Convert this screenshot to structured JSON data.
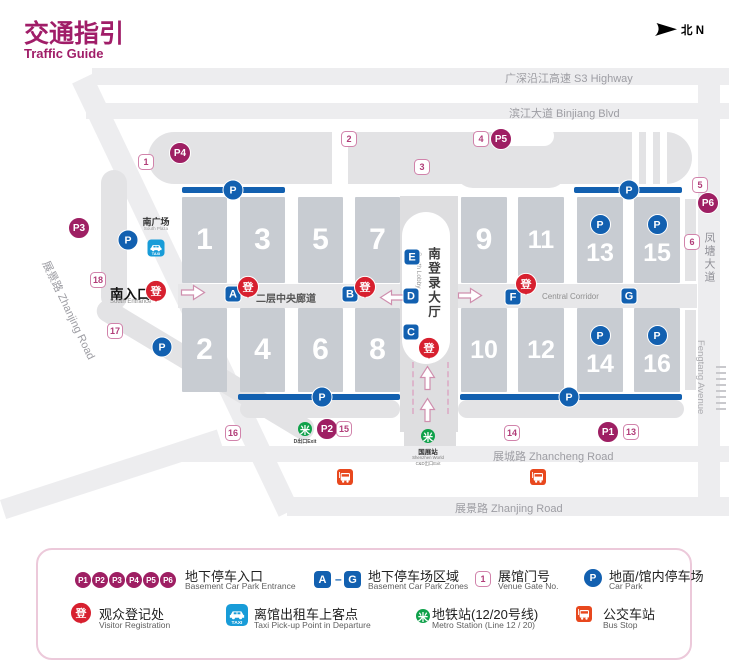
{
  "header": {
    "title_zh": "交通指引",
    "title_en": "Traffic Guide",
    "compass": "北 N"
  },
  "symbols": {
    "p": "P",
    "reg": "登",
    "taxi": "TAXI",
    "metro_glyph": "米",
    "dash": "–"
  },
  "colors": {
    "magenta": "#9e1f63",
    "blue": "#1260b0",
    "red": "#d7202f",
    "taxi_blue": "#189cd8",
    "green": "#0fa14a",
    "orange": "#e8481e",
    "hall_gray": "#c8ccd2"
  },
  "roads": {
    "s3": "广深沿江高速 S3 Highway",
    "binjiang": "滨江大道 Binjiang Blvd",
    "zhanjing_diag": "展景路 Zhanjing Road",
    "zhancheng": "展城路 Zhancheng Road",
    "zhanjing_bottom": "展景路 Zhanjing Road",
    "fengtang_zh": "凤塘大道",
    "fengtang_en": "Fengtang Avenue"
  },
  "labels": {
    "south_plaza_zh": "南广场",
    "south_plaza_en": "South Plaza",
    "south_entrance_zh": "南入口",
    "south_entrance_en": "South Entrance",
    "south_lobby_zh": "南登录大厅",
    "south_lobby_en": "South Lobby",
    "corridor_zh": "二层中央廊道",
    "corridor_en": "Central Corridor",
    "metro_d_exit": "D出口Exit",
    "station_zh": "国展站",
    "station_en": "Shenzhen World",
    "station_exit": "C&D出口Exit"
  },
  "map": {
    "halls": [
      {
        "num": "1",
        "x": 182,
        "y": 197,
        "w": 45,
        "h": 86
      },
      {
        "num": "3",
        "x": 240,
        "y": 197,
        "w": 45,
        "h": 86
      },
      {
        "num": "5",
        "x": 298,
        "y": 197,
        "w": 45,
        "h": 86
      },
      {
        "num": "7",
        "x": 355,
        "y": 197,
        "w": 45,
        "h": 86
      },
      {
        "num": "9",
        "x": 461,
        "y": 197,
        "w": 46,
        "h": 86
      },
      {
        "num": "11",
        "x": 518,
        "y": 197,
        "w": 46,
        "h": 86
      },
      {
        "num": "13",
        "x": 577,
        "y": 197,
        "w": 46,
        "h": 86,
        "p": true
      },
      {
        "num": "15",
        "x": 634,
        "y": 197,
        "w": 46,
        "h": 86,
        "p": true
      },
      {
        "num": "2",
        "x": 182,
        "y": 308,
        "w": 45,
        "h": 84
      },
      {
        "num": "4",
        "x": 240,
        "y": 308,
        "w": 45,
        "h": 84
      },
      {
        "num": "6",
        "x": 298,
        "y": 308,
        "w": 45,
        "h": 84
      },
      {
        "num": "8",
        "x": 355,
        "y": 308,
        "w": 45,
        "h": 84
      },
      {
        "num": "10",
        "x": 461,
        "y": 308,
        "w": 46,
        "h": 84
      },
      {
        "num": "12",
        "x": 518,
        "y": 308,
        "w": 46,
        "h": 84
      },
      {
        "num": "14",
        "x": 577,
        "y": 308,
        "w": 46,
        "h": 84,
        "p": true
      },
      {
        "num": "16",
        "x": 634,
        "y": 308,
        "w": 46,
        "h": 84,
        "p": true
      }
    ],
    "park_bars": [
      {
        "x": 182,
        "y": 187,
        "w": 103,
        "px": 233
      },
      {
        "x": 574,
        "y": 187,
        "w": 108,
        "px": 629
      },
      {
        "x": 238,
        "y": 394,
        "w": 162,
        "px": 322
      },
      {
        "x": 460,
        "y": 394,
        "w": 222,
        "px": 569
      }
    ],
    "car_parks": [
      {
        "x": 128,
        "y": 240
      },
      {
        "x": 162,
        "y": 347
      }
    ],
    "basement_entrances": [
      {
        "l": "P1",
        "x": 608,
        "y": 432
      },
      {
        "l": "P2",
        "x": 327,
        "y": 429
      },
      {
        "l": "P3",
        "x": 79,
        "y": 228
      },
      {
        "l": "P4",
        "x": 180,
        "y": 153
      },
      {
        "l": "P5",
        "x": 501,
        "y": 139
      },
      {
        "l": "P6",
        "x": 708,
        "y": 203
      }
    ],
    "gates": [
      {
        "n": "1",
        "x": 146,
        "y": 162
      },
      {
        "n": "2",
        "x": 349,
        "y": 139
      },
      {
        "n": "3",
        "x": 422,
        "y": 167
      },
      {
        "n": "4",
        "x": 481,
        "y": 139
      },
      {
        "n": "5",
        "x": 700,
        "y": 185
      },
      {
        "n": "6",
        "x": 692,
        "y": 242
      },
      {
        "n": "13",
        "x": 631,
        "y": 432
      },
      {
        "n": "14",
        "x": 512,
        "y": 433
      },
      {
        "n": "15",
        "x": 344,
        "y": 429
      },
      {
        "n": "16",
        "x": 233,
        "y": 433
      },
      {
        "n": "17",
        "x": 115,
        "y": 331
      },
      {
        "n": "18",
        "x": 98,
        "y": 280
      }
    ],
    "zones": [
      {
        "l": "A",
        "x": 233,
        "y": 294
      },
      {
        "l": "B",
        "x": 350,
        "y": 294
      },
      {
        "l": "C",
        "x": 411,
        "y": 332
      },
      {
        "l": "D",
        "x": 411,
        "y": 296
      },
      {
        "l": "E",
        "x": 412,
        "y": 257
      },
      {
        "l": "F",
        "x": 513,
        "y": 297
      },
      {
        "l": "G",
        "x": 629,
        "y": 296
      }
    ],
    "reg_pins": [
      {
        "x": 156,
        "y": 292
      },
      {
        "x": 248,
        "y": 288
      },
      {
        "x": 365,
        "y": 288
      },
      {
        "x": 526,
        "y": 285
      },
      {
        "x": 429,
        "y": 349
      }
    ],
    "arrows": [
      {
        "d": "right",
        "x": 193,
        "y": 295
      },
      {
        "d": "left",
        "x": 392,
        "y": 295
      },
      {
        "d": "right",
        "x": 470,
        "y": 298
      },
      {
        "d": "up",
        "x": 430,
        "y": 378
      },
      {
        "d": "up",
        "x": 430,
        "y": 410
      }
    ],
    "transit": {
      "taxi": {
        "x": 156,
        "y": 248
      },
      "metro_left": {
        "x": 305,
        "y": 429
      },
      "metro_right": {
        "x": 428,
        "y": 436
      },
      "bus": [
        {
          "x": 345,
          "y": 477
        },
        {
          "x": 538,
          "y": 477
        }
      ]
    }
  },
  "legend": {
    "p_labels": [
      "P1",
      "P2",
      "P3",
      "P4",
      "P5",
      "P6"
    ],
    "zone_from": "A",
    "zone_to": "G",
    "gate_sample": "1",
    "r1": [
      {
        "zh": "地下停车入口",
        "en": "Basement Car Park Entrance"
      },
      {
        "zh": "地下停车场区域",
        "en": "Basement Car Park Zones"
      },
      {
        "zh": "展馆门号",
        "en": "Venue Gate No."
      },
      {
        "zh": "地面/馆内停车场",
        "en": "Car Park"
      }
    ],
    "r2": [
      {
        "zh": "观众登记处",
        "en": "Visitor Registration"
      },
      {
        "zh": "离馆出租车上客点",
        "en": "Taxi Pick-up Point in Departure"
      },
      {
        "zh": "地铁站(12/20号线)",
        "en": "Metro Station (Line 12 / 20)"
      },
      {
        "zh": "公交车站",
        "en": "Bus Stop"
      }
    ]
  }
}
